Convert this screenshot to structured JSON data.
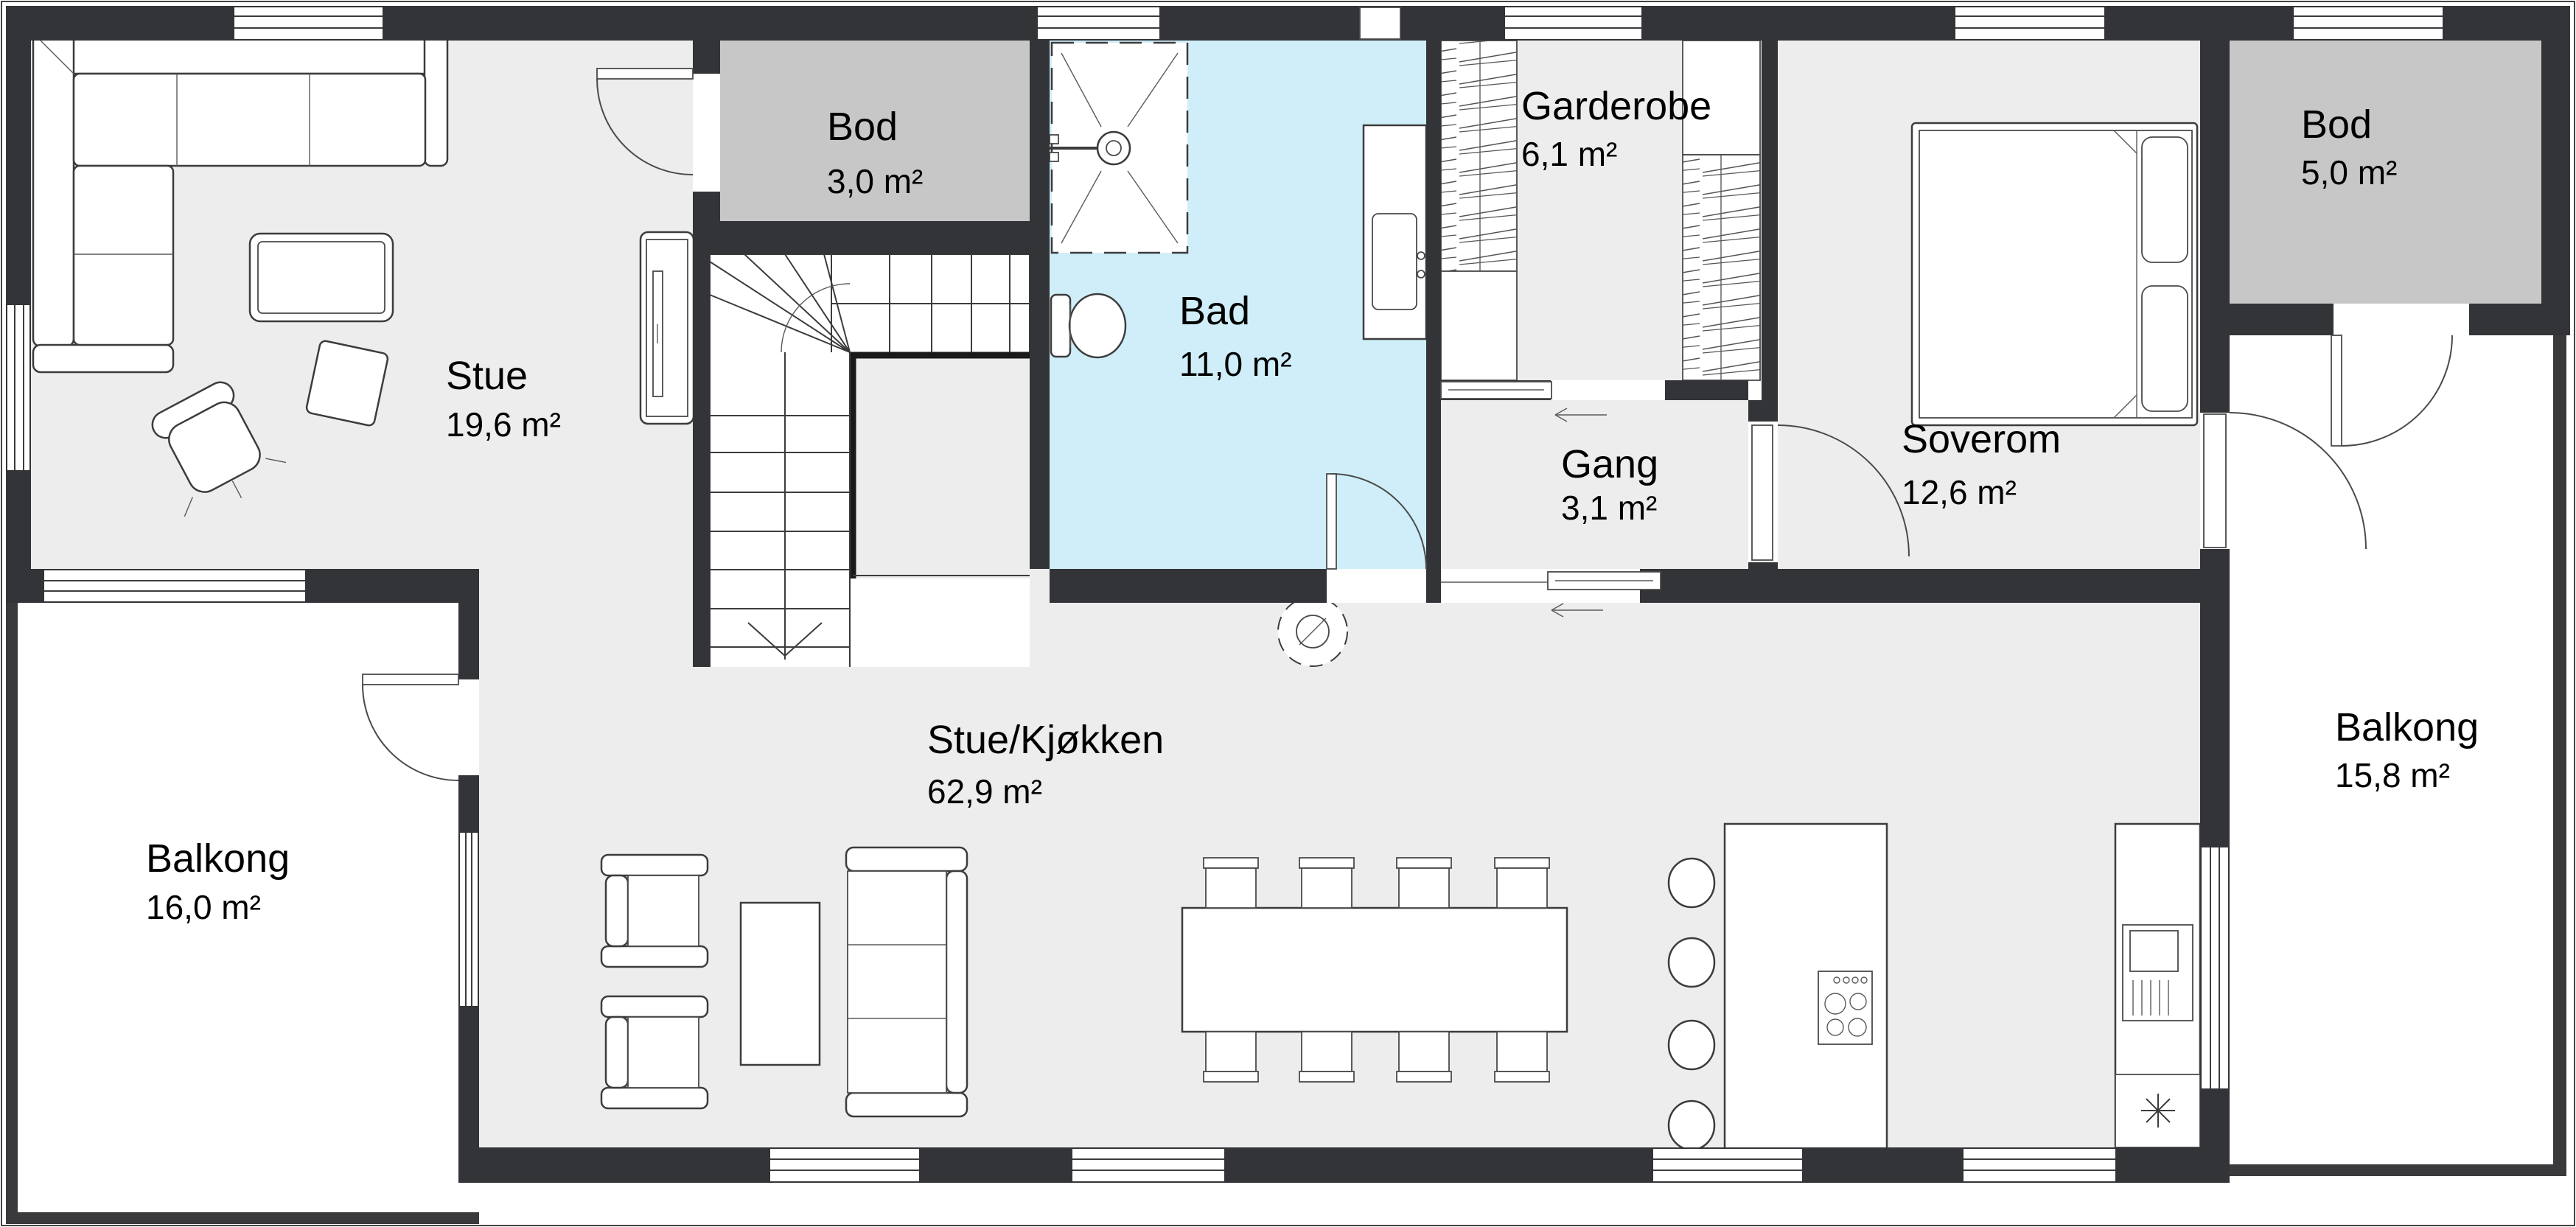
{
  "plan_type": "floor-plan",
  "language": "norwegian",
  "colors": {
    "wall": "#333437",
    "floor": "#ededed",
    "bathroom_floor": "#cfeef9",
    "storage_floor": "#c7c7c7",
    "background": "#ffffff",
    "line": "#3c3c3c",
    "text": "#000000"
  },
  "rooms": {
    "stue": {
      "name": "Stue",
      "area": "19,6 m²"
    },
    "bod_top": {
      "name": "Bod",
      "area": "3,0 m²"
    },
    "bad": {
      "name": "Bad",
      "area": "11,0 m²"
    },
    "garderobe": {
      "name": "Garderobe",
      "area": "6,1 m²"
    },
    "gang": {
      "name": "Gang",
      "area": "3,1 m²"
    },
    "soverom": {
      "name": "Soverom",
      "area": "12,6 m²"
    },
    "bod_right": {
      "name": "Bod",
      "area": "5,0 m²"
    },
    "balkong_right": {
      "name": "Balkong",
      "area": "15,8 m²"
    },
    "balkong_left": {
      "name": "Balkong",
      "area": "16,0 m²"
    },
    "stue_kjokken": {
      "name": "Stue/Kjøkken",
      "area": "62,9 m²"
    }
  },
  "fixtures": [
    "corner-sofa",
    "coffee-table",
    "swivel-chair",
    "ottoman",
    "tv-bench",
    "stairs",
    "shower",
    "toilet",
    "vanity",
    "wardrobe",
    "bed",
    "dining-table",
    "dining-chairs",
    "kitchen-island",
    "cooktop",
    "bar-stools",
    "dishwasher",
    "freezer",
    "chimney"
  ]
}
